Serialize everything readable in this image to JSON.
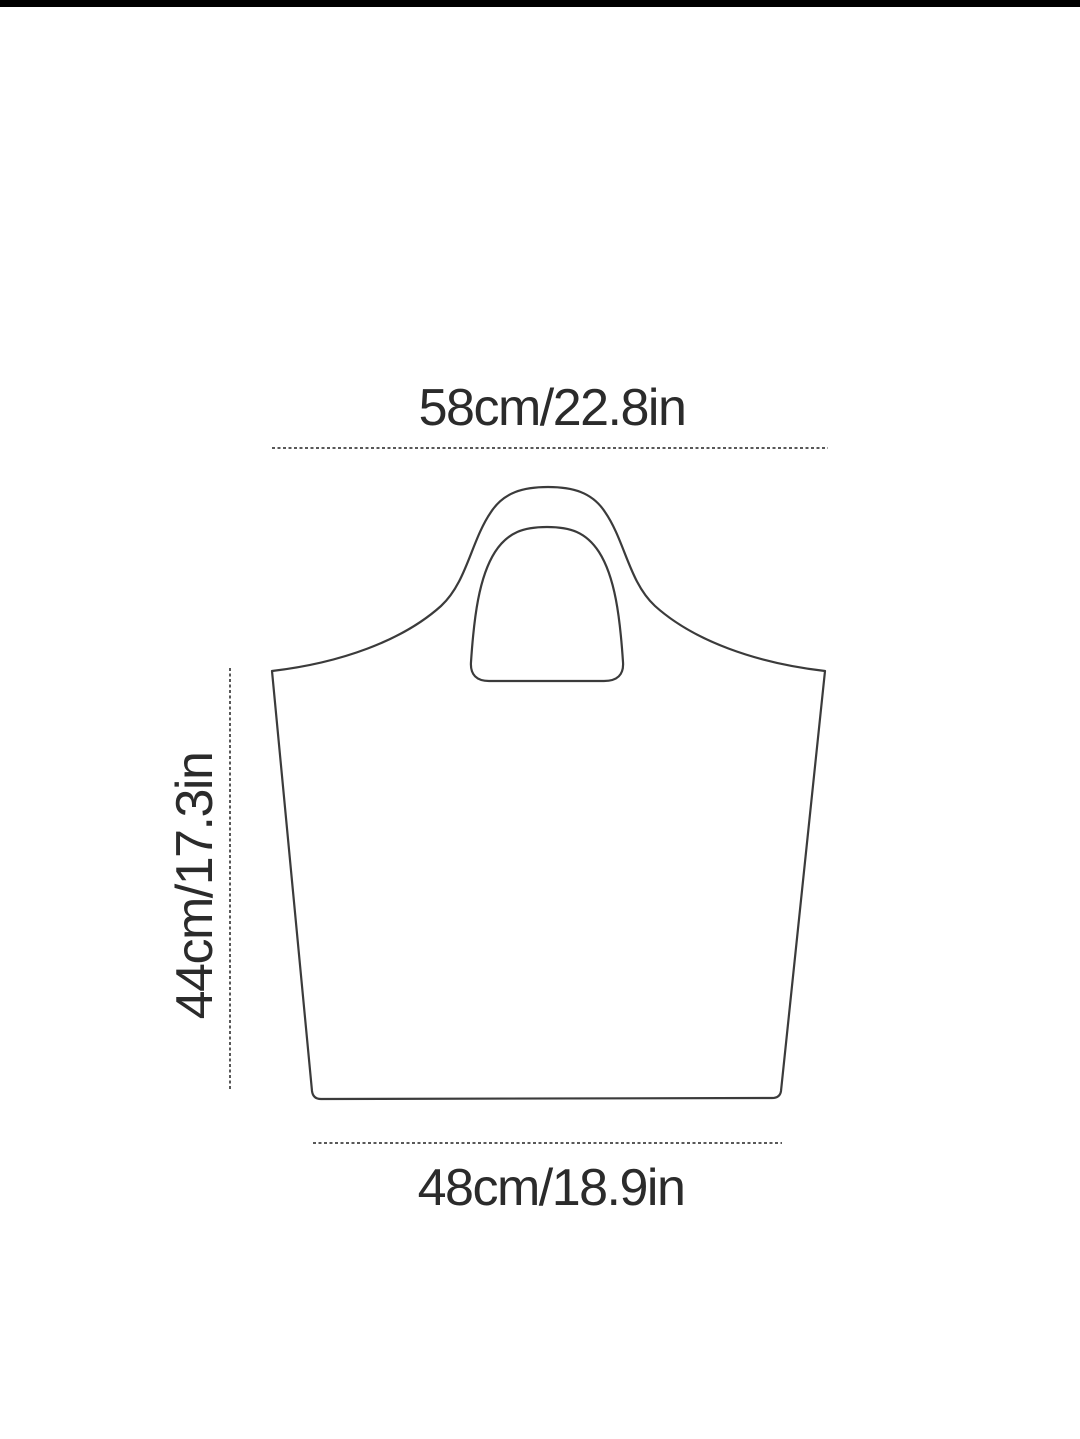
{
  "page": {
    "background": "#ffffff",
    "top_bar_color": "#000000"
  },
  "diagram": {
    "kind": "product-dimension-diagram",
    "subject": "tote-bag-outline",
    "outline_color": "#3b3b3b",
    "dash_color": "#585858",
    "text_color": "#2b2b2b",
    "dimensions": {
      "top_width": {
        "label": "58cm/22.8in",
        "cm": 58,
        "inches": 22.8,
        "orientation": "horizontal"
      },
      "height": {
        "label": "44cm/17.3in",
        "cm": 44,
        "inches": 17.3,
        "orientation": "vertical"
      },
      "bottom_width": {
        "label": "48cm/18.9in",
        "cm": 48,
        "inches": 18.9,
        "orientation": "horizontal"
      }
    }
  }
}
